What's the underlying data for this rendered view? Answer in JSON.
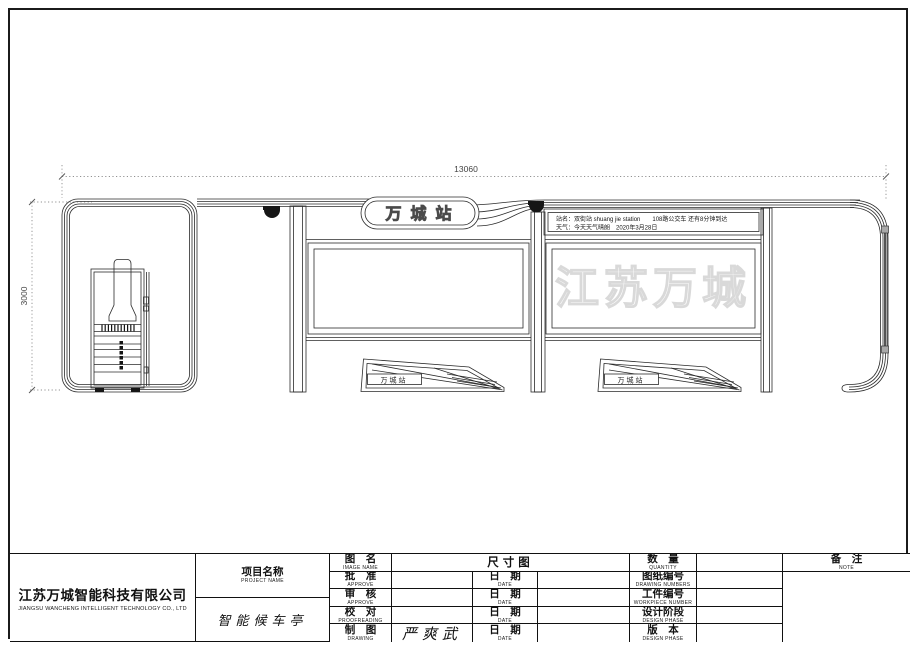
{
  "drawing": {
    "dim_width": "13060",
    "dim_height": "3000",
    "station_sign": "万城站",
    "board_line1": "站名：双街站 shuang jie station　　108路公交车 还有8分钟到达",
    "board_line2": "天气：今天天气晴朗　2020年3月28日",
    "bench_label": "万城站",
    "watermark": "江苏万城"
  },
  "colors": {
    "line": "#2b2b2b",
    "dim": "#6e6e6e",
    "dome": "#161616",
    "watermark_stroke": "#d9d9d9"
  },
  "titleblock": {
    "company_cn": "江苏万城智能科技有限公司",
    "company_en": "JIANGSU WANCHENG INTELLIGENT TECHNOLOGY CO., LTD",
    "project_label_cn": "项目名称",
    "project_label_en": "PROJECT NAME",
    "project_value": "智能候车亭",
    "drawing_name": {
      "label_cn": "图　名",
      "label_en": "IMAGE NAME",
      "value": "尺寸图"
    },
    "approve1": {
      "label_cn": "批　准",
      "label_en": "APPROVE",
      "value": "",
      "date_label_cn": "日　期",
      "date_label_en": "DATE",
      "date_value": ""
    },
    "approve2": {
      "label_cn": "审　核",
      "label_en": "APPROVE",
      "value": "",
      "date_label_cn": "日　期",
      "date_label_en": "DATE",
      "date_value": ""
    },
    "proofread": {
      "label_cn": "校　对",
      "label_en": "PROOFREADING",
      "value": "",
      "date_label_cn": "日　期",
      "date_label_en": "DATE",
      "date_value": ""
    },
    "draft": {
      "label_cn": "制　图",
      "label_en": "DRAWING",
      "value": "严爽武",
      "date_label_cn": "日　期",
      "date_label_en": "DATE",
      "date_value": ""
    },
    "quantity": {
      "label_cn": "数　量",
      "label_en": "QUANTITY",
      "value": ""
    },
    "drawing_no": {
      "label_cn": "图纸编号",
      "label_en": "DRAWING NUMBERS",
      "value": ""
    },
    "workpiece_no": {
      "label_cn": "工件编号",
      "label_en": "WORKPIECE NUMBER",
      "value": ""
    },
    "design_phase": {
      "label_cn": "设计阶段",
      "label_en": "DESIGN PHASE",
      "value": ""
    },
    "version": {
      "label_cn": "版　本",
      "label_en": "DESIGN PHASE",
      "value": ""
    },
    "note": {
      "label_cn": "备　注",
      "label_en": "NOTE",
      "value": ""
    }
  }
}
